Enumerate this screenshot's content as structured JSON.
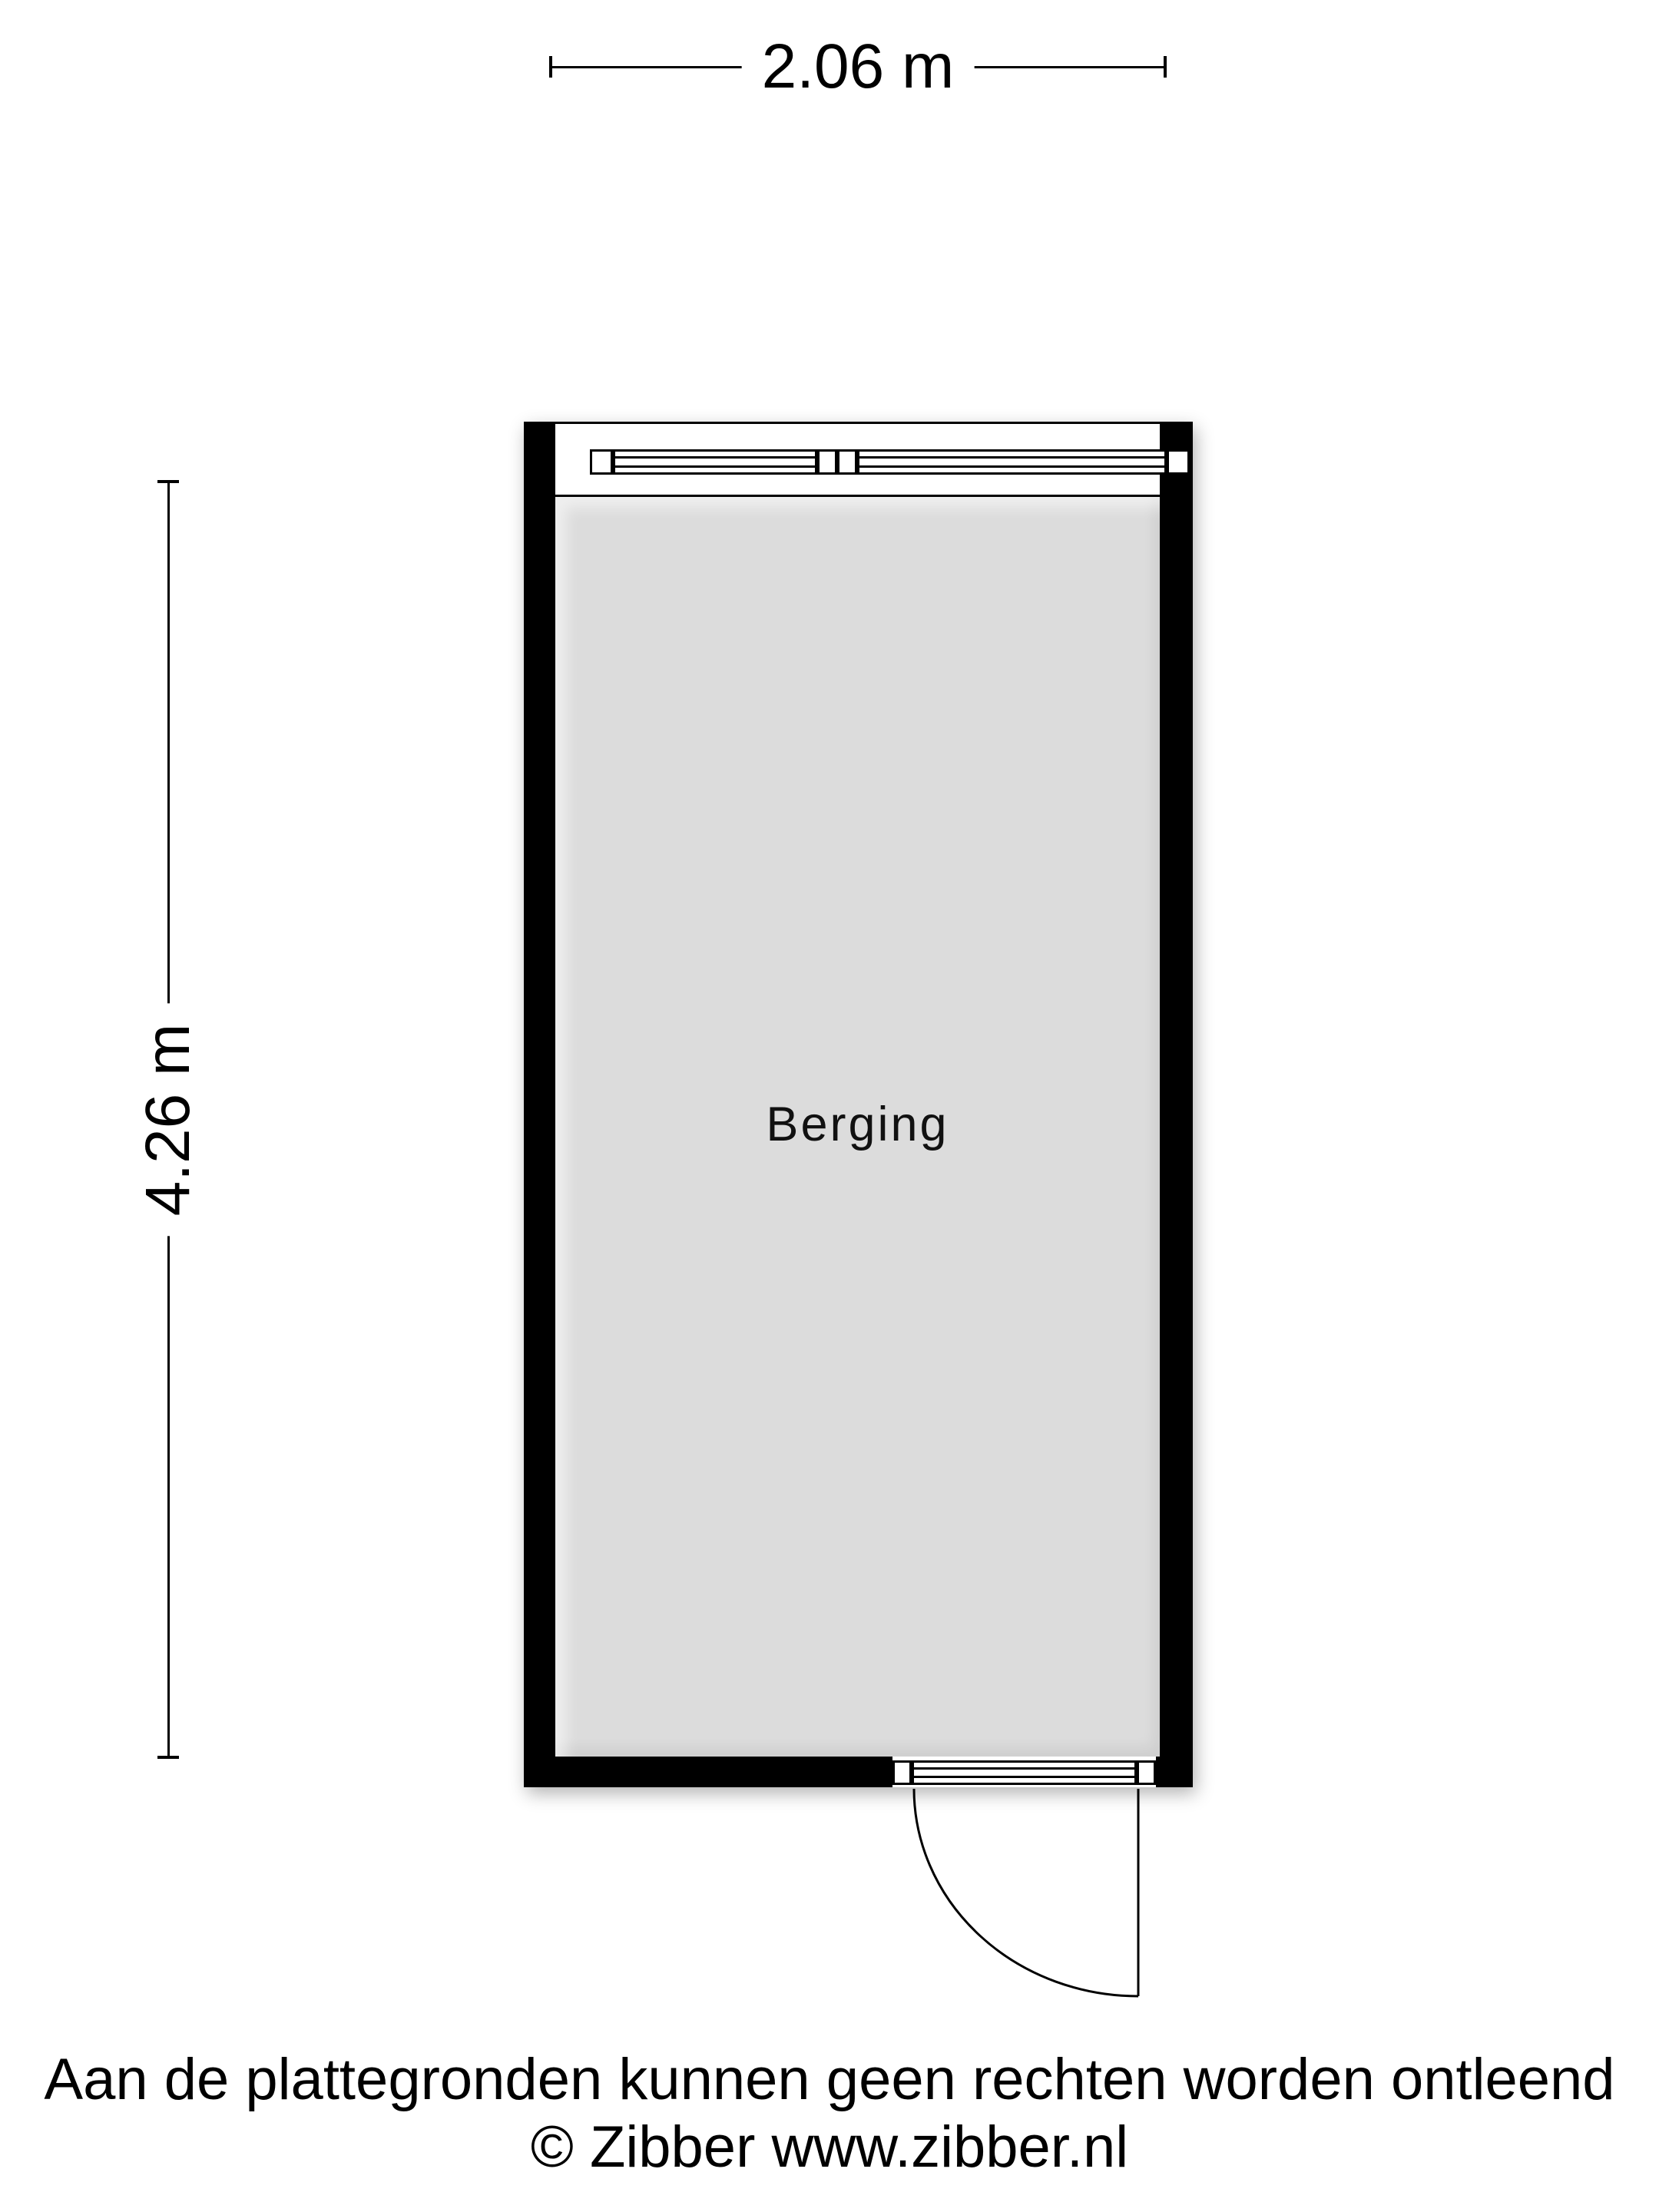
{
  "floorplan": {
    "room": {
      "label": "Berging"
    },
    "dimensions": {
      "width_label": "2.06 m",
      "height_label": "4.26 m"
    },
    "colors": {
      "wall": "#000000",
      "floor": "#dcdcdc",
      "line": "#000000",
      "background": "#ffffff"
    }
  },
  "footer": {
    "disclaimer": "Aan de plattegronden kunnen geen rechten worden ontleend",
    "copyright": "© Zibber www.zibber.nl"
  }
}
